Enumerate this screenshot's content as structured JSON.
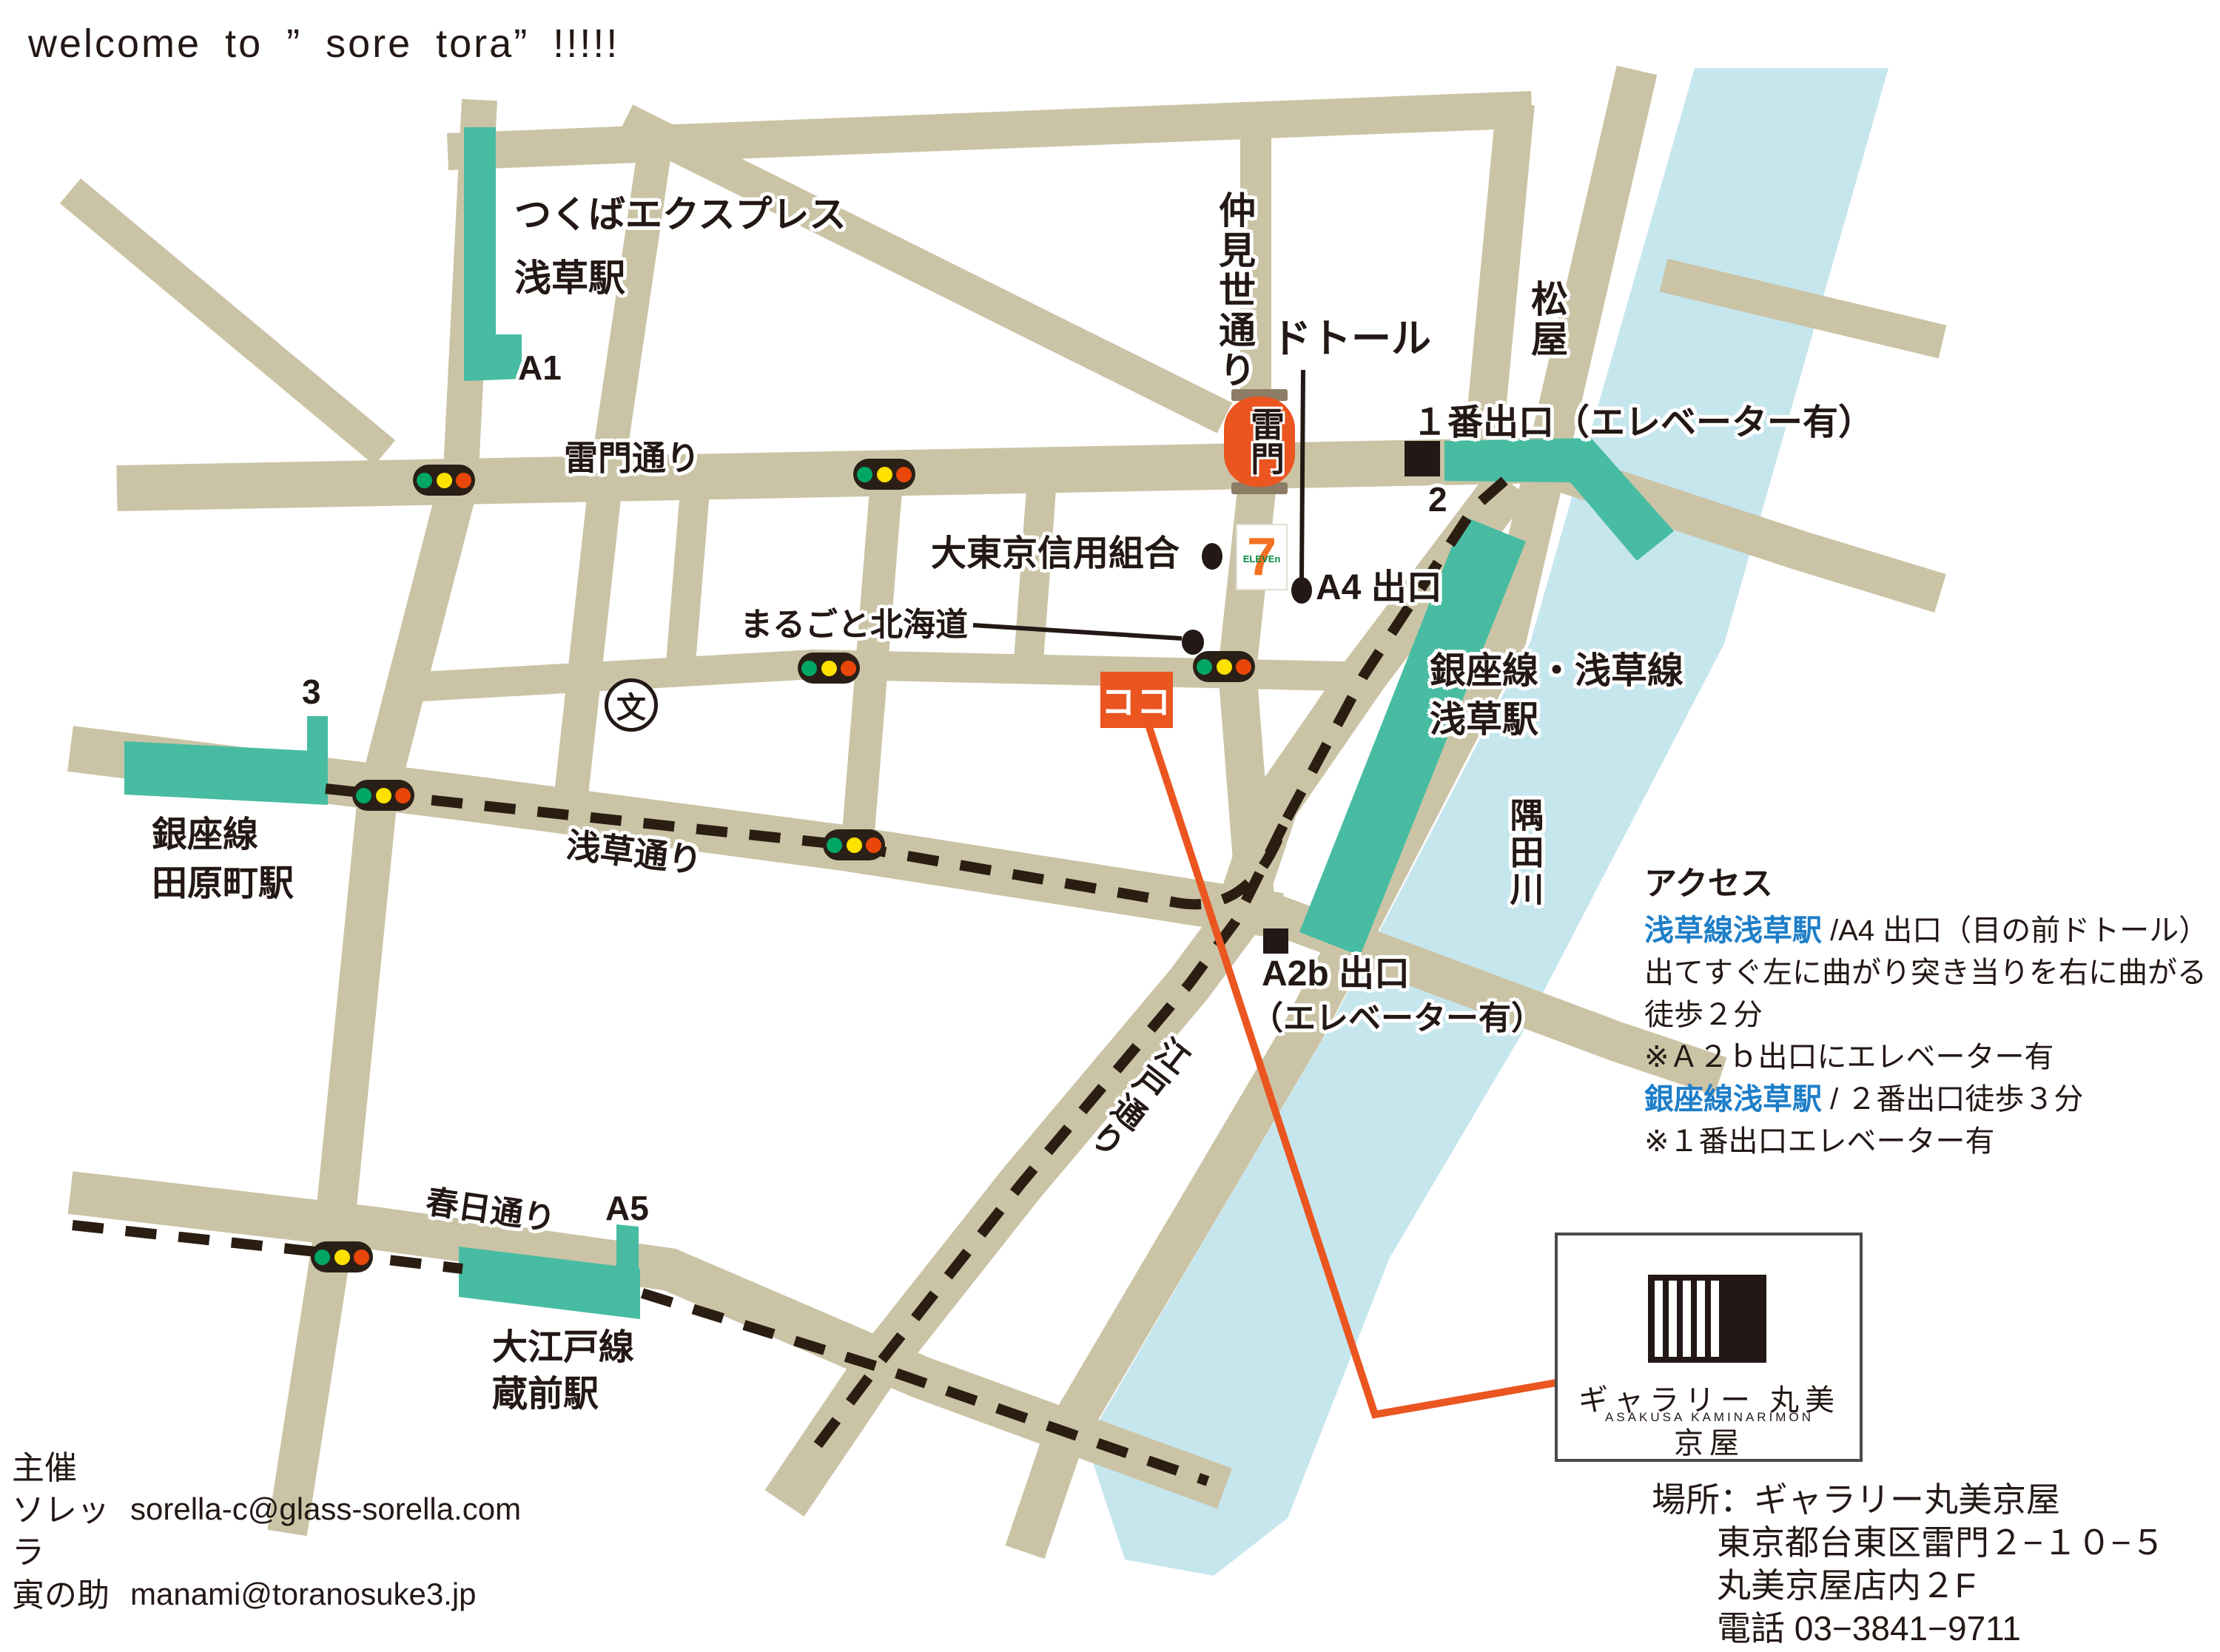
{
  "heading": "welcome to ” sore tora” !!!!!",
  "colors": {
    "road": "#CBC3A5",
    "teal": "#47BCA2",
    "river": "#C6E6EE",
    "orange": "#EA5520",
    "ink": "#231815",
    "blue": "#1E7EC8",
    "cap": "#8D7D67",
    "light-green": "#00A763",
    "light-yellow": "#FFE100",
    "light-red": "#E94709",
    "seven-orange": "#F36F21",
    "seven-green": "#008A45"
  },
  "map": {
    "streets": {
      "kaminarimon_dori": "雷門通り",
      "asakusa_dori": "浅草通り",
      "kasuga_dori": "春日通り",
      "edo_dori": "江戸通り",
      "nakamise_dori": "仲見世通り"
    },
    "stations": {
      "tsukuba": {
        "line1": "つくばエクスプレス",
        "line2": "浅草駅",
        "exit": "A1"
      },
      "ginza_asakusa": {
        "line1": "銀座線・浅草線",
        "line2": "浅草駅"
      },
      "tawaramachi": {
        "line1": "銀座線",
        "line2": "田原町駅",
        "exit": "3"
      },
      "kuramae": {
        "line1": "大江戸線",
        "line2": "蔵前駅",
        "exit": "A5"
      },
      "exit1": "１番出口（エレベーター有）",
      "exit2": "2",
      "a4": "A4 出口",
      "a2b_line1": "A2b 出口",
      "a2b_line2": "（エレベーター有）"
    },
    "pois": {
      "kaminarimon": "雷門",
      "doutor": "ドトール",
      "matsuya": "松屋",
      "daitokyo": "大東京信用組合",
      "marugoto": "まるごと北海道",
      "koko": "ココ",
      "sumida": "隅田川",
      "school": "文",
      "seven_7": "7",
      "seven_eleven": "ELEVEn"
    }
  },
  "access": {
    "title": "アクセス",
    "lines": [
      {
        "blue": "浅草線浅草駅",
        "black": " /A4 出口（目の前ドトール）"
      },
      {
        "black": "出てすぐ左に曲がり突き当りを右に曲がる"
      },
      {
        "black": "徒歩２分"
      },
      {
        "black": "※Ａ２ｂ出口にエレベーター有"
      },
      {
        "blue": "銀座線浅草駅",
        "black": " / ２番出口徒歩３分"
      },
      {
        "black": "※１番出口エレベーター有"
      }
    ]
  },
  "logo": {
    "name": "ギャラリー 丸美京屋",
    "sub": "ASAKUSA KAMINARIMON"
  },
  "venue": {
    "line1": "場所：ギャラリー丸美京屋",
    "line2": "東京都台東区雷門２−１０−５",
    "line3": "丸美京屋店内２F",
    "line4": "電話 03−3841−9711"
  },
  "organizer": {
    "title": "主催",
    "rows": [
      {
        "name": "ソレッラ",
        "email": "sorella-c@glass-sorella.com"
      },
      {
        "name": "寅の助",
        "email": "manami@toranosuke3.jp"
      }
    ]
  }
}
